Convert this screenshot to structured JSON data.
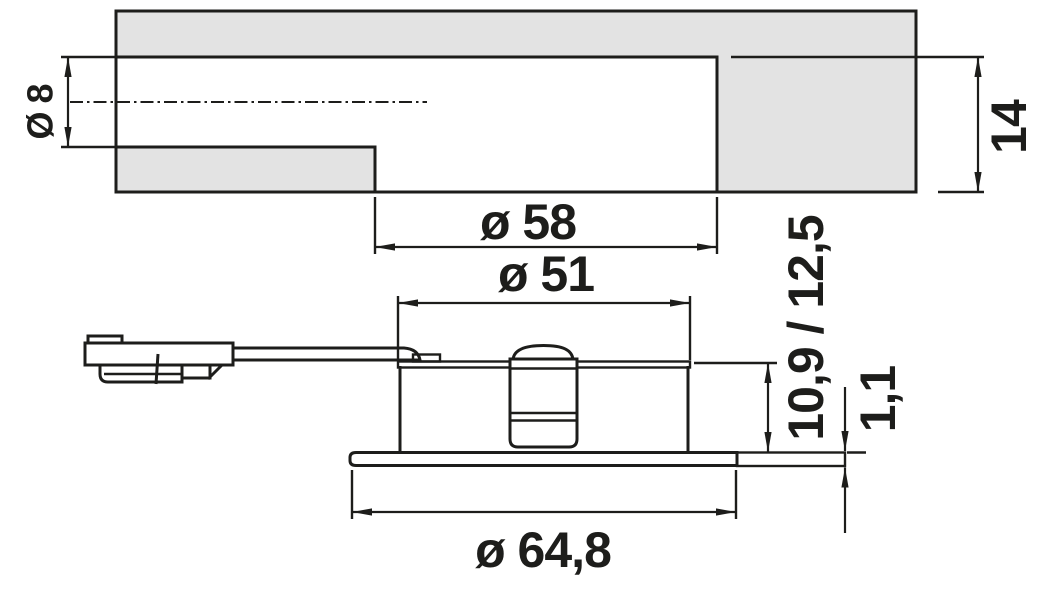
{
  "drawing": {
    "type": "technical-dimension-drawing",
    "views": {
      "top": "panel cross-section with stepped mounting bore",
      "bottom": "recessed luminaire side view with plug and cable"
    },
    "labels": {
      "channel_diameter": "Ø 8",
      "bore_diameter": "ø 58",
      "bore_depth": "14",
      "recess_depth": "10,9 / 12,5",
      "body_diameter": "ø 51",
      "rim_thickness": "1,1",
      "flange_diameter": "ø 64,8"
    },
    "colors": {
      "line": "#1d1d1b",
      "panel_fill": "#e3e3e3",
      "background": "#ffffff"
    }
  }
}
